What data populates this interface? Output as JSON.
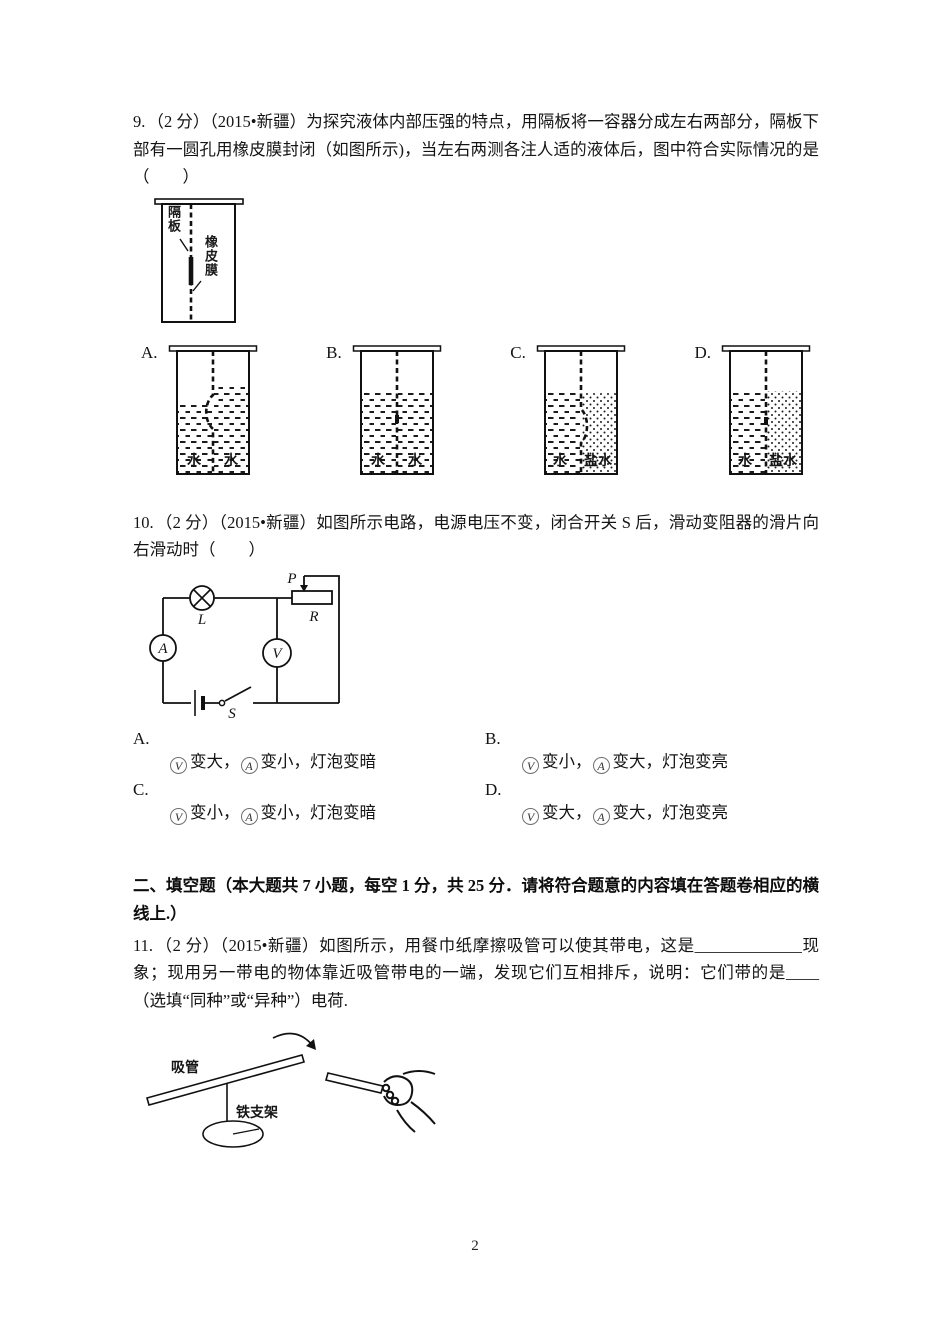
{
  "page": {
    "number": "2"
  },
  "q9": {
    "number": "9.",
    "text": "（2 分）（2015•新疆）为探究液体内部压强的特点，用隔板将一容器分成左右两部分，隔板下部有一圆孔用橡皮膜封闭（如图所示)，当左右两测各注人适的液体后，图中符合实际情况的是（　　）",
    "figure_labels": {
      "partition": "隔板",
      "membrane": "橡皮膜"
    },
    "options": [
      {
        "label": "A.",
        "left_liquid": "水",
        "right_liquid": "水"
      },
      {
        "label": "B.",
        "left_liquid": "水",
        "right_liquid": "水"
      },
      {
        "label": "C.",
        "left_liquid": "水",
        "right_liquid": "盐水"
      },
      {
        "label": "D.",
        "left_liquid": "水",
        "right_liquid": "盐水"
      }
    ]
  },
  "q10": {
    "number": "10.",
    "text": "（2 分）（2015•新疆）如图所示电路，电源电压不变，闭合开关 S 后，滑动变阻器的滑片向右滑动时（　　）",
    "circuit_labels": {
      "slider": "P",
      "rheostat": "R",
      "lamp": "L",
      "ammeter": "A",
      "voltmeter": "V",
      "switch": "S"
    },
    "meter_symbols": {
      "v": "V",
      "a": "A"
    },
    "options": [
      {
        "label": "A.",
        "v_text": "变大，",
        "a_text": "变小，",
        "bulb_text": "灯泡变暗"
      },
      {
        "label": "B.",
        "v_text": "变小，",
        "a_text": "变大，",
        "bulb_text": "灯泡变亮"
      },
      {
        "label": "C.",
        "v_text": "变小，",
        "a_text": "变小，",
        "bulb_text": "灯泡变暗"
      },
      {
        "label": "D.",
        "v_text": "变大，",
        "a_text": "变大，",
        "bulb_text": "灯泡变亮"
      }
    ]
  },
  "section2": {
    "title": "二、填空题（本大题共 7 小题，每空 1 分，共 25 分．请将符合题意的内容填在答题卷相应的横线上.）"
  },
  "q11": {
    "number": "11.",
    "text": "（2 分）（2015•新疆）如图所示，用餐巾纸摩擦吸管可以使其带电，这是_____________现象；现用另一带电的物体靠近吸管带电的一端，发现它们互相排斥，说明：它们带的是____（选填“同种”或“异种”）电荷.",
    "figure_labels": {
      "straw": "吸管",
      "stand": "铁支架"
    }
  }
}
